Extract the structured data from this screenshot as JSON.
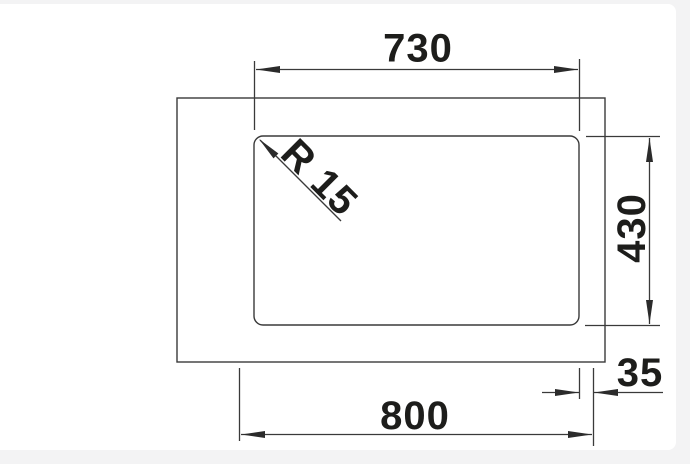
{
  "page": {
    "background_color": "#f3f3f4",
    "panel_color": "#ffffff"
  },
  "drawing": {
    "type": "technical-dimension-drawing",
    "subject": "sink-top-view-with-bowl-cutout",
    "line_color": "#3a3a3a",
    "text_color": "#1d1d1b",
    "labels": {
      "inner_width": "730",
      "inner_height": "430",
      "outer_width": "800",
      "edge_offset": "35",
      "corner_radius": "R 15"
    }
  }
}
